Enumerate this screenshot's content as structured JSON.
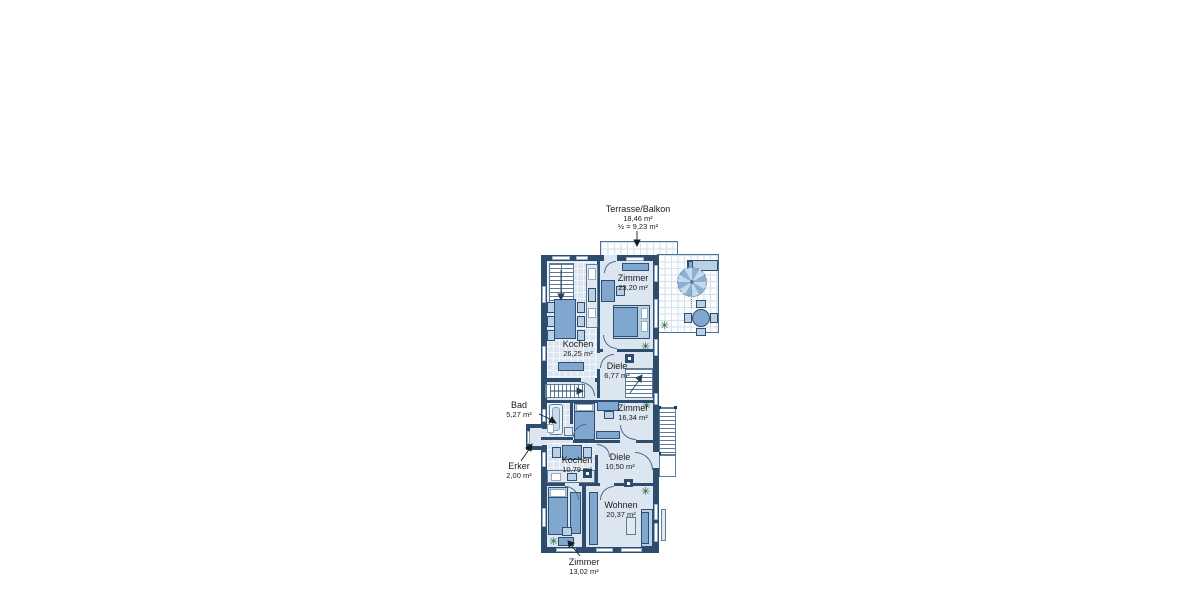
{
  "colors": {
    "wall": "#2e4d6e",
    "floor": "#dce6f0",
    "furniture": "#7fa7cf",
    "furniture_light": "#b9d0e5",
    "terrace_grid": "#d5dfe9",
    "plant_green": "#1d5a2a",
    "text": "#1b1b1b"
  },
  "icons": {
    "plant": "✳"
  },
  "plan": {
    "labels": {
      "terrasse": {
        "name": "Terrasse/Balkon",
        "area": "18,46 m²",
        "half": "½ = 9,23 m²"
      },
      "zimmer_og": {
        "name": "Zimmer",
        "area": "23,20 m²"
      },
      "kochen_og": {
        "name": "Kochen",
        "area": "26,25 m²"
      },
      "diele_og": {
        "name": "Diele",
        "area": "6,77 m²"
      },
      "bad": {
        "name": "Bad",
        "area": "5,27 m²"
      },
      "zimmer_mid": {
        "name": "Zimmer",
        "area": "16,34 m²"
      },
      "kochen_eg": {
        "name": "Kochen",
        "area": "10,79 m²"
      },
      "diele_eg": {
        "name": "Diele",
        "area": "10,50 m²"
      },
      "erker": {
        "name": "Erker",
        "area": "2,00 m²"
      },
      "wohnen": {
        "name": "Wohnen",
        "area": "20,37 m²"
      },
      "zimmer_eg": {
        "name": "Zimmer",
        "area": "13,02 m²"
      }
    }
  }
}
